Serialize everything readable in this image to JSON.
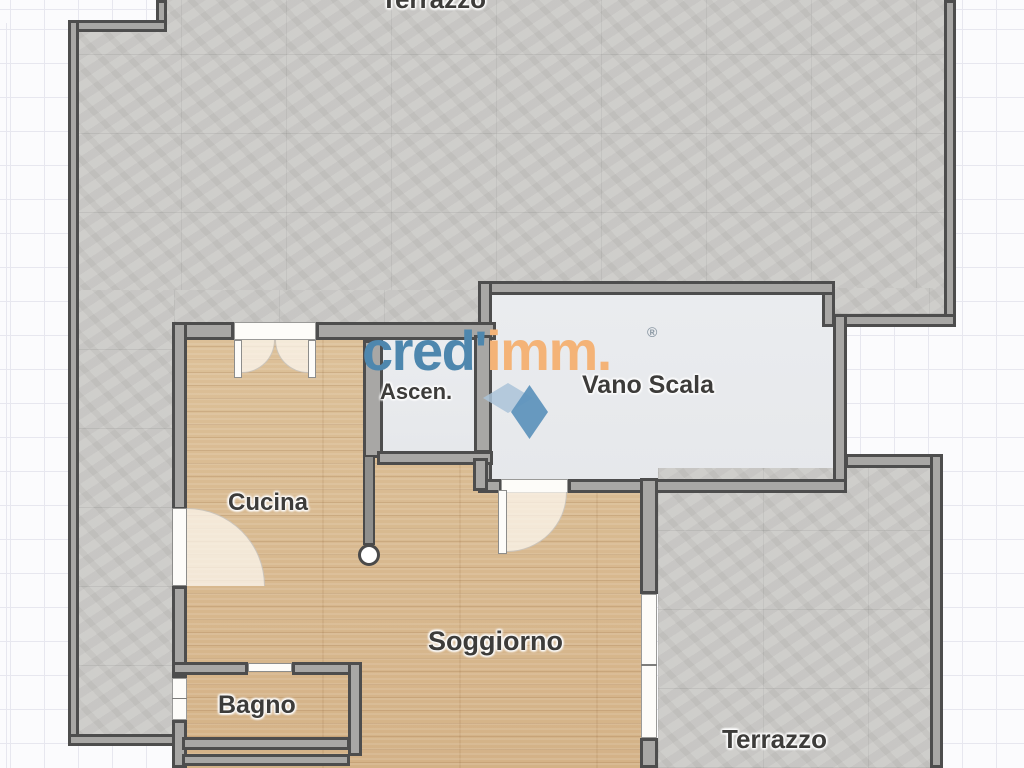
{
  "floor_plan": {
    "watermark": {
      "brand_part1": "cred'",
      "brand_part2": "imm.",
      "registered_mark": "®"
    },
    "labels": {
      "terrazzo_top": "Terrazzo",
      "ascensore": "Ascen.",
      "vano_scala": "Vano Scala",
      "cucina": "Cucina",
      "soggiorno": "Soggiorno",
      "bagno": "Bagno",
      "terrazzo_right": "Terrazzo"
    },
    "colors": {
      "wood_floor": "#d9bc92",
      "terrace_floor": "#c9c8c5",
      "stairwell_floor": "#e9ebee",
      "wall_dark": "#4d4d4d",
      "wall_fill": "#a8a7a5",
      "logo_blue": "#4e87ae",
      "logo_orange": "#f4b377",
      "grid_line": "#e7e7ef",
      "background": "#fbfbfd"
    }
  }
}
